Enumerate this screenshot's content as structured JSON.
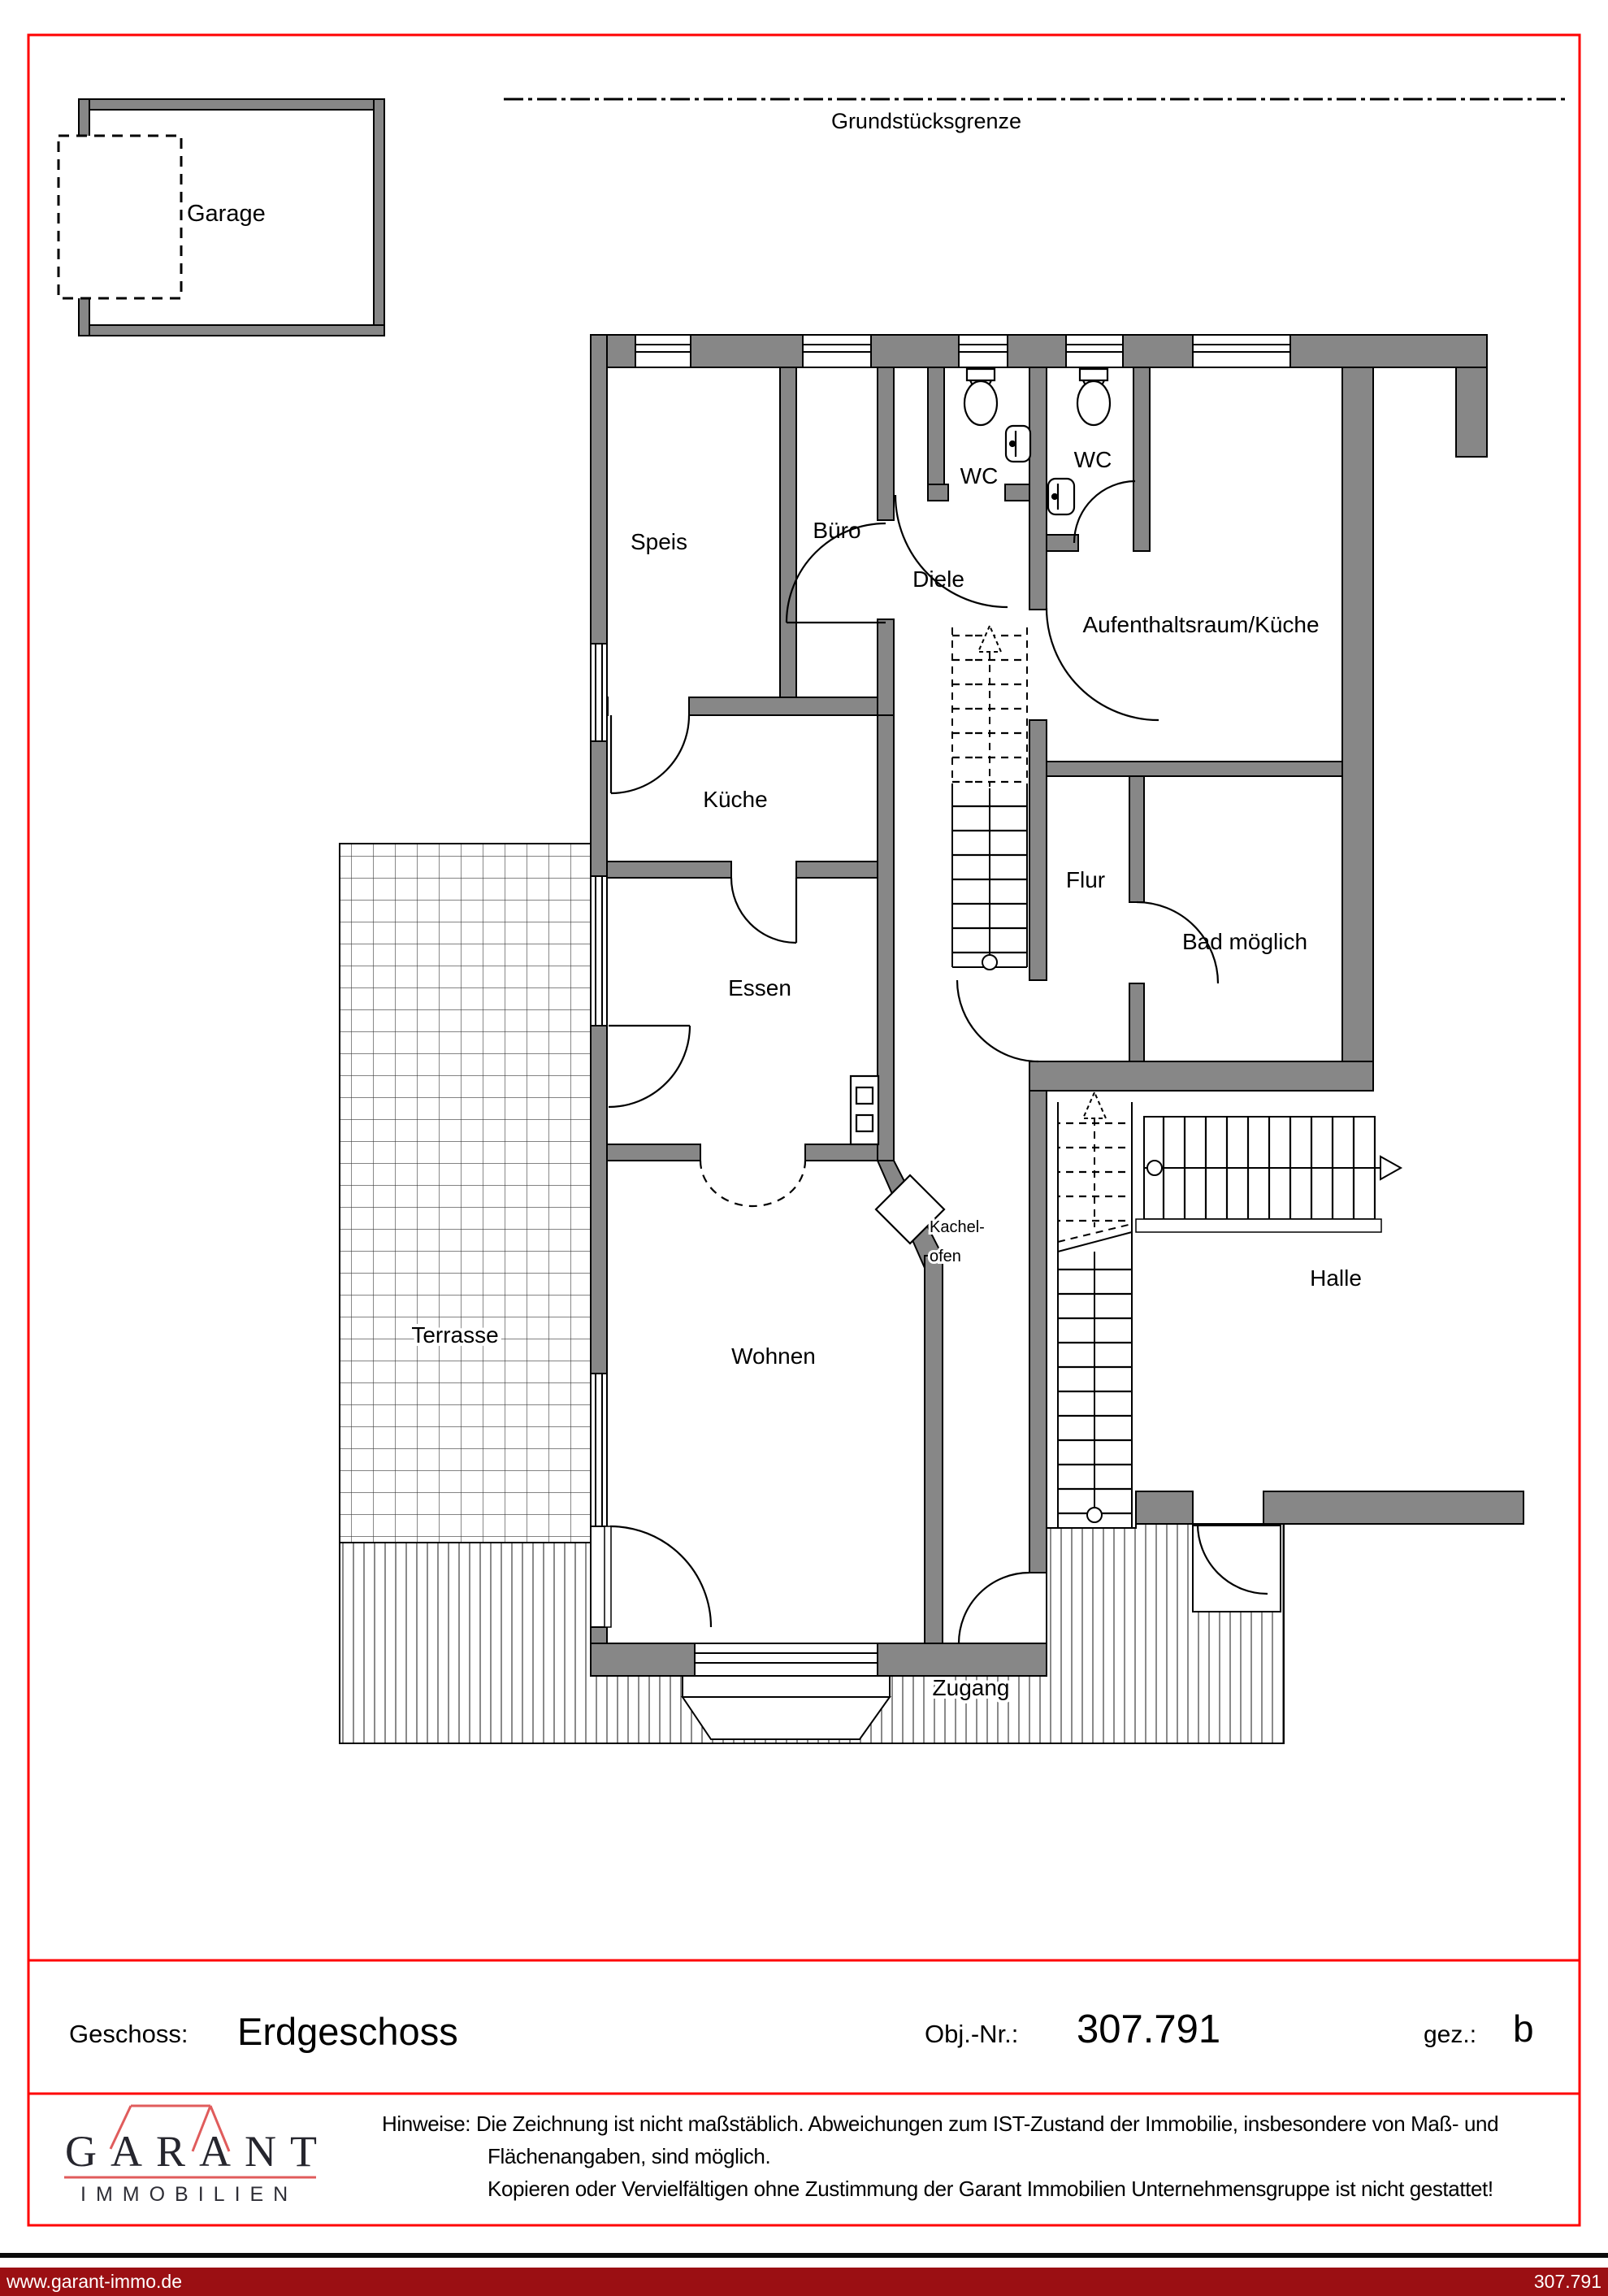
{
  "colors": {
    "frame_red": "#ff0000",
    "wall_gray": "#878787",
    "footer_bar_red": "#9b0f13",
    "logo_roof_red": "#e05c5c",
    "logo_text": "#26262e"
  },
  "plan": {
    "boundary_label": "Grundstücksgrenze",
    "garage_label": "Garage",
    "rooms": {
      "speis": "Speis",
      "buero": "Büro",
      "wc1": "WC",
      "wc2": "WC",
      "diele": "Diele",
      "aufenthaltsraum": "Aufenthaltsraum/Küche",
      "kueche": "Küche",
      "flur": "Flur",
      "bad": "Bad möglich",
      "essen": "Essen",
      "kachelofen_line1": "Kachel-",
      "kachelofen_line2": "ofen",
      "terrasse": "Terrasse",
      "wohnen": "Wohnen",
      "halle": "Halle",
      "zugang": "Zugang"
    }
  },
  "title_block": {
    "floor_label": "Geschoss:",
    "floor_value": "Erdgeschoss",
    "object_label": "Obj.-Nr.:",
    "object_value": "307.791",
    "drawn_label": "gez.:",
    "drawn_value": "b"
  },
  "brand": {
    "name": "GARANT",
    "subtitle": "IMMOBILIEN"
  },
  "notes": {
    "label": "Hinweise:",
    "line1": "Die Zeichnung ist nicht maßstäblich. Abweichungen zum IST-Zustand der Immobilie, insbesondere von Maß- und",
    "line2": "Flächenangaben, sind möglich.",
    "line3": "Kopieren oder Vervielfältigen ohne Zustimmung der Garant Immobilien Unternehmensgruppe ist nicht gestattet!"
  },
  "footer": {
    "website": "www.garant-immo.de",
    "object_number": "307.791"
  }
}
